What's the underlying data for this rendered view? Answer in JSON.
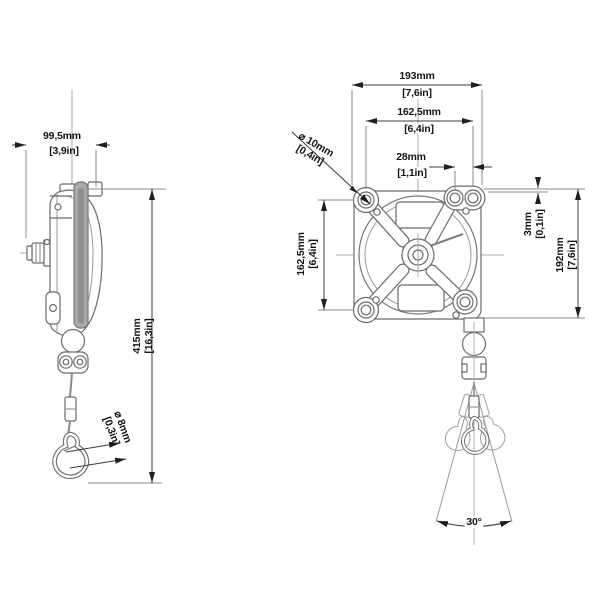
{
  "drawing": {
    "subject": "tool balancer",
    "views": {
      "side_view": "side profile with ball joint, cable, ferrule and carabiner hook",
      "front_view": "mounting plate with X-bracket, drum, cable outlet and swing cone"
    }
  },
  "dimensions": {
    "side_depth": {
      "mm": "99,5mm",
      "in": "[3,9in]"
    },
    "side_height": {
      "mm": "415mm",
      "in": "[16,3in]"
    },
    "cable_diameter": {
      "mm": "⌀ 8mm",
      "in": "[0,3in]"
    },
    "front_width": {
      "mm": "193mm",
      "in": "[7,6in]"
    },
    "hole_spacing_horizontal": {
      "mm": "162,5mm",
      "in": "[6,4in]"
    },
    "hole_offset_top_right": {
      "mm": "28mm",
      "in": "[1,1in]"
    },
    "mounting_hole_diameter": {
      "mm": "⌀ 10mm",
      "in": "[0,4in]"
    },
    "hole_spacing_vertical": {
      "mm": "162,5mm",
      "in": "[6,4in]"
    },
    "bracket_plate_offset": {
      "mm": "3mm",
      "in": "[0,1in]"
    },
    "front_height": {
      "mm": "192mm",
      "in": "[7,6in]"
    },
    "swing_angle": {
      "value": "30°"
    }
  },
  "colors": {
    "line": "#6b6b6b",
    "thin_line": "#9a9a9a",
    "arrow": "#1f1f1f",
    "text": "#141414",
    "gray_fill": "#a9a9a9"
  }
}
